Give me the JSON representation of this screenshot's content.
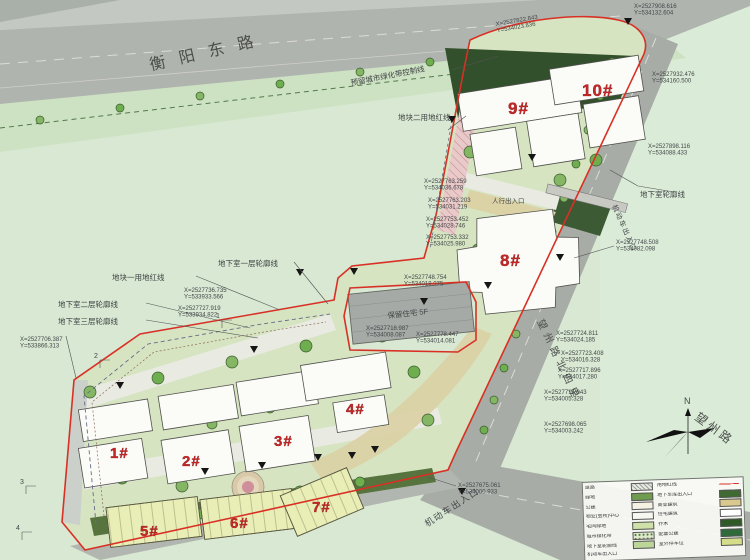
{
  "roads": {
    "top": "衡阳东路",
    "side": "望州路北四里",
    "bottom": "望州路"
  },
  "labels": {
    "green_belt": "预留城市绿化带控制线",
    "plot2_line": "地块二用地红线",
    "plot1_line": "地块一用地红线",
    "basement1": "地下室一层轮廓线",
    "basement2": "地下室二层轮廓线",
    "basement3": "地下室三层轮廓线",
    "basement_r": "地下室轮廓线",
    "vehicle_entry": "机动车出入口",
    "ped_entry": "人行出入口",
    "retained": "保留住宅 5F"
  },
  "buildings": [
    "1#",
    "2#",
    "3#",
    "4#",
    "5#",
    "6#",
    "7#",
    "8#",
    "9#",
    "10#"
  ],
  "compass": {
    "label": "N"
  },
  "sections": [
    "1",
    "2",
    "3",
    "4"
  ],
  "coordinates": [
    {
      "x": "X=2527822.843",
      "y": "Y=534023.836",
      "px": 496,
      "py": 26,
      "rot": -10
    },
    {
      "x": "X=2527908.616",
      "y": "Y=534132.604",
      "px": 634,
      "py": 8,
      "rot": 0
    },
    {
      "x": "X=2527932.476",
      "y": "Y=534160.500",
      "px": 652,
      "py": 76,
      "rot": 0
    },
    {
      "x": "X=2527898.116",
      "y": "Y=534088.433",
      "px": 648,
      "py": 148,
      "rot": 0
    },
    {
      "x": "X=2527748.508",
      "y": "Y=534082.098",
      "px": 616,
      "py": 244,
      "rot": 0
    },
    {
      "x": "X=2527763.259",
      "y": "Y=534036.678",
      "px": 424,
      "py": 183,
      "rot": 0
    },
    {
      "x": "X=2527763.203",
      "y": "Y=534031.219",
      "px": 428,
      "py": 202,
      "rot": 0
    },
    {
      "x": "X=2527753.452",
      "y": "Y=534028.746",
      "px": 426,
      "py": 221,
      "rot": 0
    },
    {
      "x": "X=2527753.332",
      "y": "Y=534025.980",
      "px": 426,
      "py": 239,
      "rot": 0
    },
    {
      "x": "X=2527748.754",
      "y": "Y=534018.075",
      "px": 404,
      "py": 279,
      "rot": 0
    },
    {
      "x": "X=2527718.987",
      "y": "Y=534008.087",
      "px": 366,
      "py": 330,
      "rot": 0
    },
    {
      "x": "X=2527778.447",
      "y": "Y=534014.081",
      "px": 416,
      "py": 336,
      "rot": 0
    },
    {
      "x": "X=2527736.735",
      "y": "Y=533933.566",
      "px": 184,
      "py": 292,
      "rot": 0
    },
    {
      "x": "X=2527727.919",
      "y": "Y=533934.822",
      "px": 178,
      "py": 310,
      "rot": 0
    },
    {
      "x": "X=2527706.387",
      "y": "Y=533866.313",
      "px": 20,
      "py": 341,
      "rot": 0
    },
    {
      "x": "X=2527724.811",
      "y": "Y=534024.185",
      "px": 556,
      "py": 335,
      "rot": 0
    },
    {
      "x": "X=2527723.408",
      "y": "Y=534016.328",
      "px": 561,
      "py": 355,
      "rot": 0
    },
    {
      "x": "X=2527717.896",
      "y": "Y=534017.280",
      "px": 558,
      "py": 372,
      "rot": 0
    },
    {
      "x": "X=2527715.943",
      "y": "Y=534005.328",
      "px": 544,
      "py": 394,
      "rot": 0
    },
    {
      "x": "X=2527698.065",
      "y": "Y=534003.242",
      "px": 544,
      "py": 426,
      "rot": 0
    },
    {
      "x": "X=2527675.061",
      "y": "Y=534000.933",
      "px": 458,
      "py": 487,
      "rot": 0
    }
  ],
  "legend": {
    "rows": [
      {
        "l1": "道路",
        "s1": "hatch",
        "l2": "用地红线",
        "s2": "redline"
      },
      {
        "l1": "绿地",
        "s1": "#6f9c4f",
        "l2": "地下车库出入口",
        "s2": "#3f6b33"
      },
      {
        "l1": "公建",
        "s1": "#f5f2e4",
        "l2": "商业建筑",
        "s2": "#d9c98f"
      },
      {
        "l1": "物业(会所)中心",
        "s1": "#f7f7f2",
        "l2": "住宅建筑",
        "s2": "#ffffff"
      },
      {
        "l1": "宅间绿地",
        "s1": "#cfe0a8",
        "l2": "乔木",
        "s2": "#2f5a28"
      },
      {
        "l1": "城市绿化带",
        "s1": "dots",
        "l2": "配套公建",
        "s2": "#2f6b3a"
      },
      {
        "l1": "地下室轮廓线",
        "s1": "#bcd69a",
        "l2": "室外停车位",
        "s2": "#d6dd8a"
      },
      {
        "l1": "机动车出入口",
        "s1": "",
        "l2": "",
        "s2": ""
      }
    ]
  },
  "colors": {
    "boundary_red": "#d93025",
    "building_label_red": "#c62828",
    "road_gray": "#a8aca6",
    "site_green": "#d6e4c2",
    "commercial_yellow": "#e9edb6",
    "dark_tree_green": "#33502c",
    "background": "#d8e8d2"
  }
}
